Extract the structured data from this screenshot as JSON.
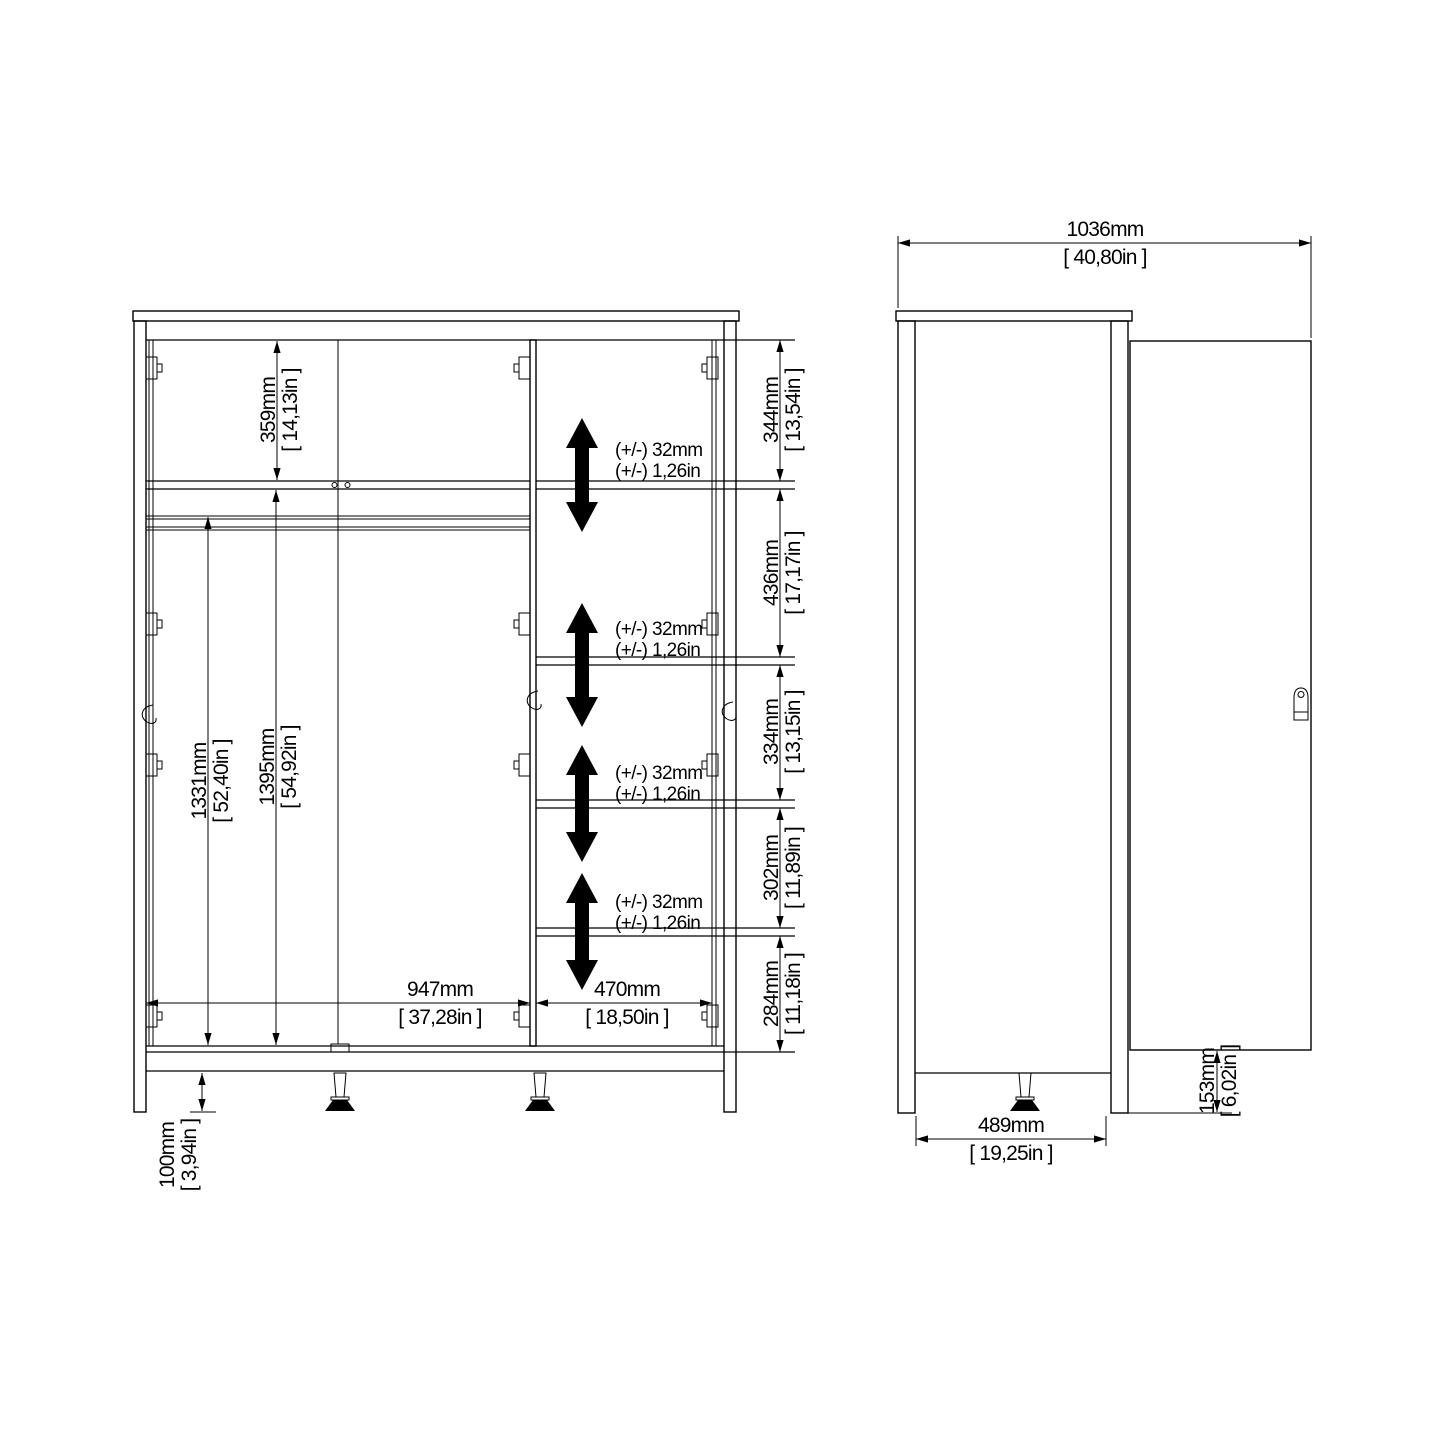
{
  "front": {
    "dim359": {
      "mm": "359mm",
      "in": "[ 14,13in ]"
    },
    "dim1395": {
      "mm": "1395mm",
      "in": "[ 54,92in ]"
    },
    "dim1331": {
      "mm": "1331mm",
      "in": "[ 52,40in ]"
    },
    "dim100": {
      "mm": "100mm",
      "in": "[ 3,94in ]"
    },
    "dim947": {
      "mm": "947mm",
      "in": "[ 37,28in ]"
    },
    "dim470": {
      "mm": "470mm",
      "in": "[ 18,50in ]"
    },
    "chain": [
      {
        "mm": "344mm",
        "in": "[ 13,54in ]"
      },
      {
        "mm": "436mm",
        "in": "[ 17,17in ]"
      },
      {
        "mm": "334mm",
        "in": "[ 13,15in ]"
      },
      {
        "mm": "302mm",
        "in": "[ 11,89in ]"
      },
      {
        "mm": "284mm",
        "in": "[ 11,18in ]"
      }
    ],
    "adjust": {
      "line1": "(+/-) 32mm",
      "line2": "(+/-) 1,26in"
    }
  },
  "side": {
    "dim1036": {
      "mm": "1036mm",
      "in": "[ 40,80in ]"
    },
    "dim489": {
      "mm": "489mm",
      "in": "[ 19,25in ]"
    },
    "dim153": {
      "mm": "153mm",
      "in": "[ 6,02in ]"
    }
  }
}
